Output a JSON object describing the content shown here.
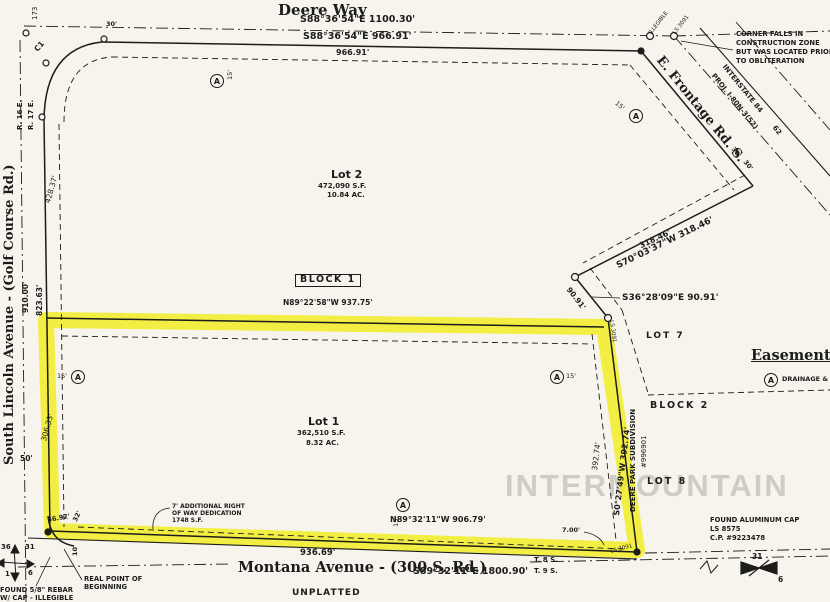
{
  "watermark": "INTERMOUNTAIN",
  "colors": {
    "paper": "#f6f4ec",
    "ink": "#1c1c1a",
    "highlight": "#f2ec19",
    "watermark": "#c7c7c0"
  },
  "streets": {
    "deere_way": "Deere Way",
    "montana": "Montana Avenue - (300 S. Rd.)",
    "lincoln": "South Lincoln Avenue - (Golf Course Rd.)",
    "frontage": "E. Frontage Rd. S.",
    "interstate": "INTERSTATE 84",
    "interstate_proj": "PROJ. I-80N-3(52)"
  },
  "parcels": {
    "lot2": {
      "name": "Lot 2",
      "area_sf": "472,090 S.F.",
      "area_ac": "10.84 AC."
    },
    "lot1": {
      "name": "Lot 1",
      "area_sf": "362,510 S.F.",
      "area_ac": "8.32 AC."
    },
    "block1": "BLOCK 1",
    "block2": "BLOCK 2",
    "lot7": "LOT 7",
    "lot8": "LOT 8",
    "subdivision": "DEERE PARK SUBDIVISION",
    "subdivision_no": "#996901",
    "unplatted": "UNPLATTED"
  },
  "dimensions": {
    "top_centerline": "S88°36'54\"E  1100.30'",
    "top_boundary": "S88°36'54\"E  966.91'",
    "top_offset": "966.91'",
    "ne_boundary": "S70°03'37\"W  318.46'",
    "ne_offset": "318.46'",
    "se_diag": "S36°28'09\"E  90.91'",
    "se_diag_len": "90.91'",
    "east_boundary": "S0°27'49\"W  392.74'",
    "east_offset": "392.74'",
    "mid_boundary": "N89°22'58\"W  937.75'",
    "south_offset": "N89°32'11\"W  906.79'",
    "south_boundary": "936.69'",
    "south_centerline": "S89°32'11\"E  1800.90'",
    "west_boundary": "823.63'",
    "west_centerline": "910.00'",
    "west_offset_upper": "428.37'",
    "west_offset_lower": "306.33'",
    "half_width_50": "50'",
    "width_30": "30'",
    "jog": "7.00'",
    "sw_1": "36.92'",
    "sw_2": "32'",
    "sw_3": "10'",
    "easement_15": "15'",
    "curve_c1": "C1",
    "station_62": "62",
    "station_173": "173"
  },
  "land_grid": {
    "range_w": "R. 16 E.",
    "range_e": "R. 17 E.",
    "twp_n": "T. 8 S.",
    "twp_s": "T. 9 S.",
    "sec_nw": "36",
    "sec_ne": "31",
    "sec_sw": "1",
    "sec_se": "6",
    "sec_ne2": "31",
    "sec_se2": "6"
  },
  "notes": {
    "corner": [
      "CORNER FALLS IN",
      "CONSTRUCTION ZONE",
      "BUT WAS LOCATED PRIOR",
      "TO OBLITERATION"
    ],
    "row_dedication": [
      "7' ADDITIONAL RIGHT",
      "OF WAY DEDICATION",
      "1748 S.F."
    ],
    "found_rebar": [
      "FOUND 5/8\" REBAR",
      "W/ CAP - ILLEGIBLE"
    ],
    "found_cap": [
      "FOUND ALUMINUM CAP",
      "LS 8575",
      "C.P. #9223478"
    ],
    "rpob": [
      "REAL POINT OF",
      "BEGINNING"
    ],
    "monument_illegible": "ILLEGIBLE",
    "monument_ls": "LS 3091"
  },
  "legend": {
    "title": "Easement",
    "symbol": "A",
    "item": "DRAINAGE &"
  }
}
